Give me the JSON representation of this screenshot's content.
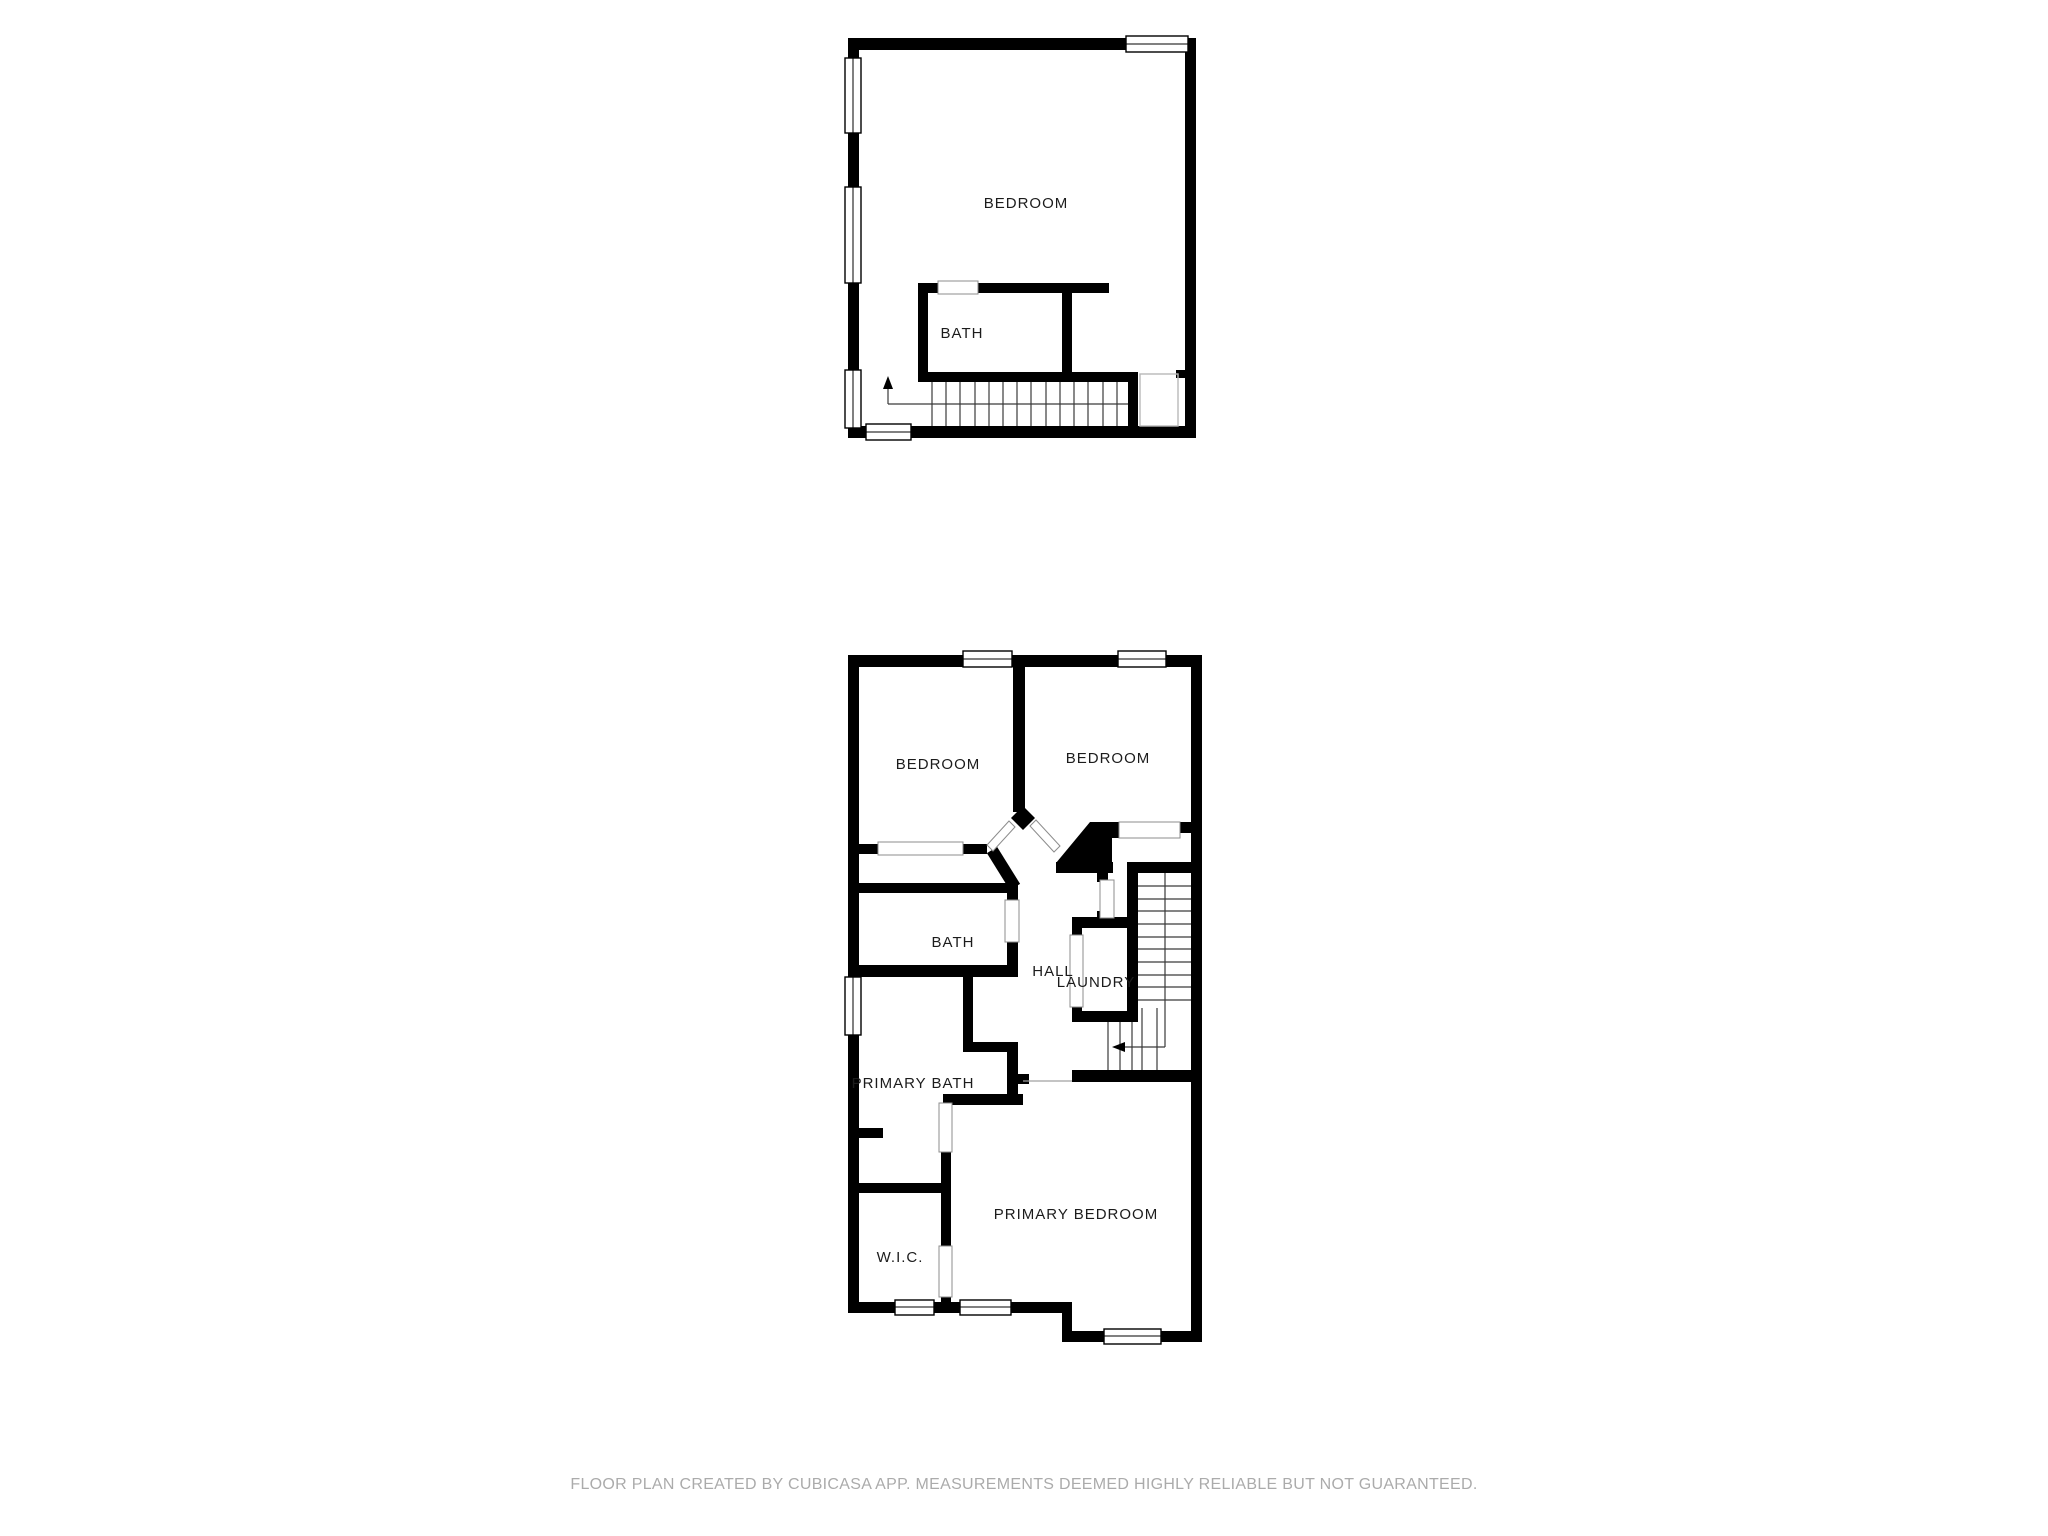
{
  "document": {
    "type": "floor-plan",
    "creator_note": "FLOOR PLAN CREATED BY CUBICASA APP. MEASUREMENTS DEEMED HIGHLY RELIABLE BUT NOT GUARANTEED."
  },
  "floors": [
    {
      "id": "upper",
      "rooms": {
        "bedroom": "BEDROOM",
        "bath": "BATH"
      },
      "features": [
        "staircase-down",
        "stair-direction-arrow-up",
        "windows"
      ]
    },
    {
      "id": "main",
      "rooms": {
        "bedroom_left": "BEDROOM",
        "bedroom_right": "BEDROOM",
        "bath": "BATH",
        "hall": "HALL",
        "laundry": "LAUNDRY",
        "primary_bath": "PRIMARY BATH",
        "wic": "W.I.C.",
        "primary_bedroom": "PRIMARY BEDROOM"
      },
      "features": [
        "staircase",
        "stair-direction-arrow-left",
        "windows",
        "door-openings"
      ]
    }
  ],
  "colors": {
    "background": "#ffffff",
    "wall": "#000000",
    "stair_line": "#3a3a3a",
    "opening_outline": "#8c8c8c",
    "label_text": "#1c1c1c",
    "footer_text": "#ababab"
  }
}
